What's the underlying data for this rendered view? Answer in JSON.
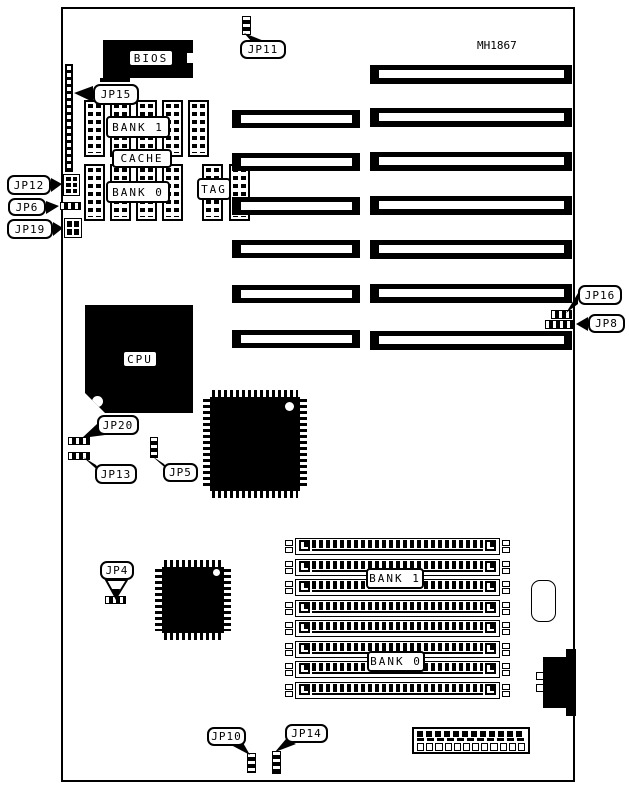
{
  "diagram": {
    "model_number": "MH1867",
    "components": {
      "bios": "BIOS",
      "cpu": "CPU",
      "cache_bank1": "BANK 1",
      "cache": "CACHE",
      "cache_bank0": "BANK 0",
      "tag": "TAG",
      "memory_bank1": "BANK 1",
      "memory_bank0": "BANK 0"
    },
    "jumpers": {
      "jp4": "JP4",
      "jp5": "JP5",
      "jp6": "JP6",
      "jp8": "JP8",
      "jp10": "JP10",
      "jp11": "JP11",
      "jp12": "JP12",
      "jp13": "JP13",
      "jp14": "JP14",
      "jp15": "JP15",
      "jp16": "JP16",
      "jp19": "JP19",
      "jp20": "JP20"
    },
    "colors": {
      "ink": "#000000",
      "paper": "#ffffff"
    }
  }
}
